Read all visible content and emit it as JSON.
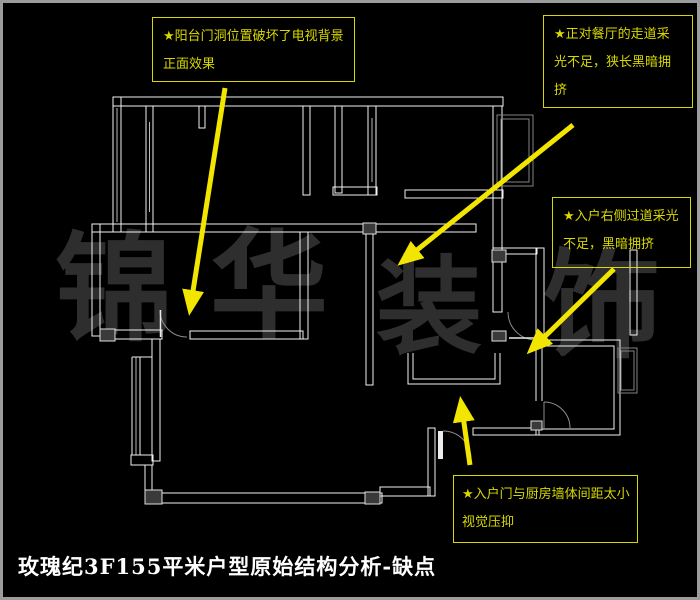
{
  "title": "玫瑰纪3F155平米户型原始结构分析-缺点",
  "watermark": {
    "text": "锦华装饰",
    "chars": [
      "锦",
      "华",
      "装",
      "饰"
    ]
  },
  "annotations": [
    {
      "id": "balcony-door-issue",
      "lines": [
        "★阳台门洞位置破坏了电视背景",
        "正面效果"
      ]
    },
    {
      "id": "dining-corridor-issue",
      "lines": [
        "★正对餐厅的走道采",
        "光不足，狭长黑暗拥",
        "挤"
      ]
    },
    {
      "id": "entry-right-corridor-issue",
      "lines": [
        "★入户右侧过道采光",
        "不足，黑暗拥挤"
      ]
    },
    {
      "id": "entry-kitchen-gap-issue",
      "lines": [
        "★入户门与厨房墙体间距太小",
        "视觉压抑"
      ]
    }
  ],
  "colors": {
    "background": "#000000",
    "frame_gray": "#9c9c9c",
    "wall_white": "#f2f2f2",
    "annotation_yellow": "#d8d800",
    "arrow_yellow": "#f2e600",
    "watermark_gray": "#2e2e2e"
  }
}
